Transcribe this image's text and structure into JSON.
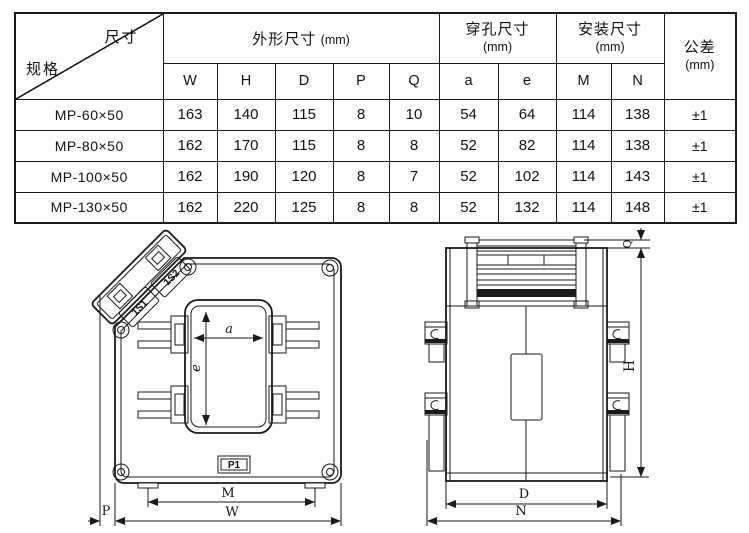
{
  "table": {
    "corner": {
      "top_label": "尺寸",
      "bottom_label": "规格"
    },
    "groups": [
      {
        "title": "外形尺寸",
        "unit": "(mm)",
        "columns": [
          "W",
          "H",
          "D",
          "P",
          "Q"
        ]
      },
      {
        "title": "穿孔尺寸",
        "unit": "(mm)",
        "columns": [
          "a",
          "e"
        ]
      },
      {
        "title": "安装尺寸",
        "unit": "(mm)",
        "columns": [
          "M",
          "N"
        ]
      },
      {
        "title": "公差",
        "unit": "(mm)"
      }
    ],
    "rows": [
      {
        "spec": "MP-60×50",
        "values": [
          "163",
          "140",
          "115",
          "8",
          "10",
          "54",
          "64",
          "114",
          "138"
        ],
        "tolerance": "±1"
      },
      {
        "spec": "MP-80×50",
        "values": [
          "162",
          "170",
          "115",
          "8",
          "8",
          "52",
          "82",
          "114",
          "138"
        ],
        "tolerance": "±1"
      },
      {
        "spec": "MP-100×50",
        "values": [
          "162",
          "190",
          "120",
          "8",
          "7",
          "52",
          "102",
          "114",
          "143"
        ],
        "tolerance": "±1"
      },
      {
        "spec": "MP-130×50",
        "values": [
          "162",
          "220",
          "125",
          "8",
          "8",
          "52",
          "132",
          "114",
          "148"
        ],
        "tolerance": "±1"
      }
    ]
  },
  "front_view": {
    "hole_width_label": "a",
    "hole_height_label": "e",
    "terminal_mark": "P1",
    "mounting_label": "M",
    "width_label": "W",
    "offset_label": "P",
    "secondary_terminal_1": "1S1",
    "secondary_terminal_2": "1S2"
  },
  "side_view": {
    "height_label": "H",
    "depth_label": "D",
    "mounting_label": "N",
    "top_label": "Q"
  },
  "colors": {
    "line": "#1a1a1a",
    "background": "#ffffff"
  }
}
